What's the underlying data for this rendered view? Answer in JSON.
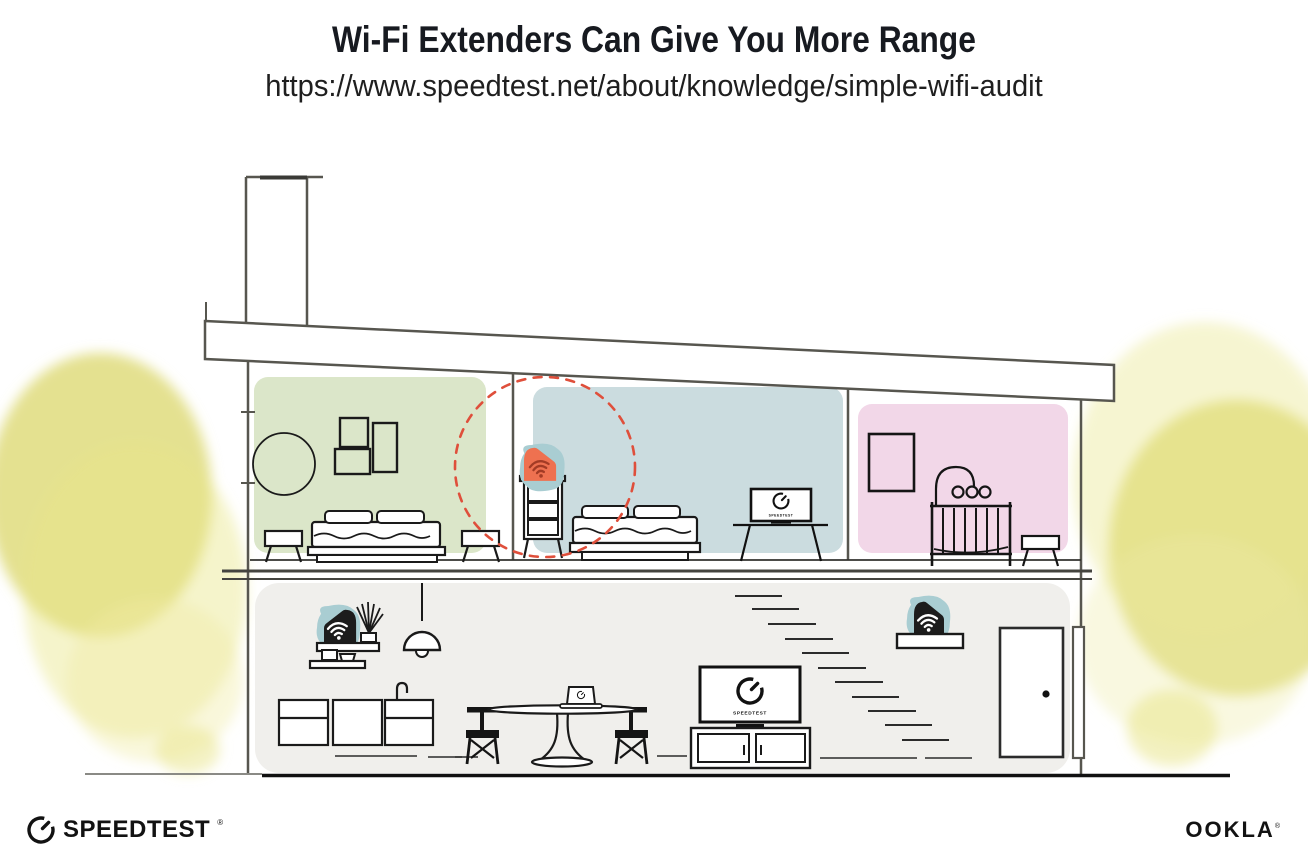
{
  "header": {
    "title": "Wi-Fi Extenders Can Give You More Range",
    "url": "https://www.speedtest.net/about/knowledge/simple-wifi-audit"
  },
  "footer": {
    "speedtest_logo": "SPEEDTEST",
    "speedtest_trademark": "®",
    "ookla_logo": "OOKLA",
    "ookla_trademark": "®"
  },
  "illustration": {
    "description": "Cross-section of a two-story house showing Wi-Fi extender placement and coverage",
    "screens": {
      "bedroom_tv_label": "SPEEDTEST",
      "living_tv_label": "SPEEDTEST"
    },
    "rooms": {
      "bedroom_left_color": "#dbe6c9",
      "bedroom_middle_color": "#cbdcdf",
      "nursery_color": "#f2d7e8",
      "ground_floor_color": "#f0efec"
    },
    "devices": {
      "extender_highlight_color": "#ee7150",
      "device_backdrop_color": "#a9cdd2",
      "range_circle_color": "#df4f3b",
      "router_color": "#1c1c1c"
    },
    "foliage_color": "#dedb78"
  }
}
